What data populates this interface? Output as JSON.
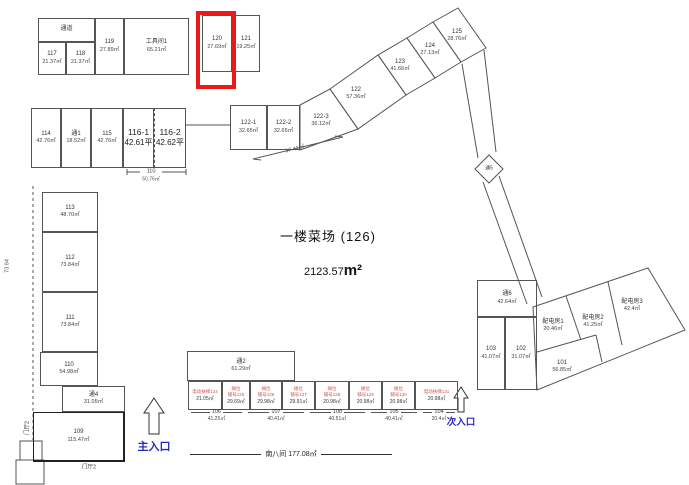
{
  "header": {
    "title": "一楼菜场 (126)",
    "total_area": "2123.57",
    "total_area_unit": "m²"
  },
  "highlight": {
    "unit": "120",
    "color": "#ea1a1a"
  },
  "entrances": {
    "main": "主入口",
    "secondary": "次入口"
  },
  "rooms": {
    "corridor_top": {
      "no": "通道"
    },
    "r117": {
      "no": "117",
      "area": "21.37㎡"
    },
    "r118": {
      "no": "118",
      "area": "21.37㎡"
    },
    "r119": {
      "no": "119",
      "area": "27.89㎡"
    },
    "tool1": {
      "no": "工具间1",
      "area": "65.21㎡"
    },
    "r120": {
      "no": "120",
      "area": "27.69㎡"
    },
    "r121": {
      "no": "121",
      "area": "19.25㎡"
    },
    "r114": {
      "no": "114",
      "area": "42.76㎡"
    },
    "t1": {
      "no": "通1",
      "area": "18.52㎡"
    },
    "r115": {
      "no": "115",
      "area": "42.76㎡"
    },
    "r116_1": {
      "no": "116-1",
      "area": "42.61平"
    },
    "r116_2": {
      "no": "116-2",
      "area": "42.62平"
    },
    "r113": {
      "no": "113",
      "area": "48.70㎡"
    },
    "r112": {
      "no": "112",
      "area": "73.84㎡"
    },
    "r111": {
      "no": "111",
      "area": "73.84㎡"
    },
    "r110": {
      "no": "110",
      "area": "54.98㎡"
    },
    "t4": {
      "no": "通4",
      "area": "31.05㎡"
    },
    "r109": {
      "no": "109",
      "area": "115.47㎡"
    },
    "t2": {
      "no": "通2",
      "area": "61.29㎡"
    },
    "r122_1": {
      "no": "122-1",
      "area": "32.65㎡"
    },
    "r122_2": {
      "no": "122-2",
      "area": "32.65㎡"
    },
    "r122_3": {
      "no": "122-3",
      "area": "36.12㎡"
    },
    "r122": {
      "no": "122",
      "area": "57.36㎡"
    },
    "r123": {
      "no": "123",
      "area": "41.66㎡"
    },
    "r124": {
      "no": "124",
      "area": "27.13㎡"
    },
    "r125": {
      "no": "125",
      "area": "28.76㎡"
    },
    "t5": {
      "no": "通5"
    },
    "t6": {
      "no": "通6",
      "area": "42.64㎡"
    },
    "r103": {
      "no": "103",
      "area": "41.07㎡"
    },
    "r102": {
      "no": "102",
      "area": "31.07㎡"
    },
    "pd1": {
      "no": "配电房1",
      "area": "20.46㎡"
    },
    "pd2": {
      "no": "配电房2",
      "area": "41.25㎡"
    },
    "pd3": {
      "no": "配电房3",
      "area": "42.4㎡"
    },
    "r101": {
      "no": "101",
      "area": "56.85㎡"
    }
  },
  "stalls": [
    {
      "label": "电动扶梯124",
      "area": "21.05㎡"
    },
    {
      "label": "摊位",
      "no": "铺号125",
      "area": "29.69㎡"
    },
    {
      "label": "摊位",
      "no": "铺号126",
      "area": "29.98㎡"
    },
    {
      "label": "摊位",
      "no": "铺号127",
      "area": "29.91㎡"
    },
    {
      "label": "摊位",
      "no": "铺号128",
      "area": "20.98㎡"
    },
    {
      "label": "摊位",
      "no": "铺号129",
      "area": "20.98㎡"
    },
    {
      "label": "摊位",
      "no": "铺号130",
      "area": "20.98㎡"
    },
    {
      "label": "电动扶梯131",
      "area": "20.98㎡"
    }
  ],
  "stall_dims": [
    {
      "no": "106",
      "area": "41.25㎡"
    },
    {
      "no": "107",
      "area": "40.41㎡"
    },
    {
      "no": "108",
      "area": "40.51㎡"
    },
    {
      "no": "105",
      "area": "40.41㎡"
    },
    {
      "no": "104",
      "area": "20.4㎡"
    }
  ],
  "dimensions": {
    "south": {
      "label": "南八间",
      "area": "177.08㎡"
    },
    "d110": {
      "no": "110",
      "area": "50.76㎡"
    },
    "d1741": "17.41㎡",
    "d7384": "73.84"
  },
  "labels": {
    "menting2_v": "门厅2",
    "menting2_b": "门厅2"
  },
  "colors": {
    "line": "#555555",
    "highlight": "#ea1a1a",
    "entrance_text": "#2929c8",
    "stall_text": "#c85555"
  }
}
